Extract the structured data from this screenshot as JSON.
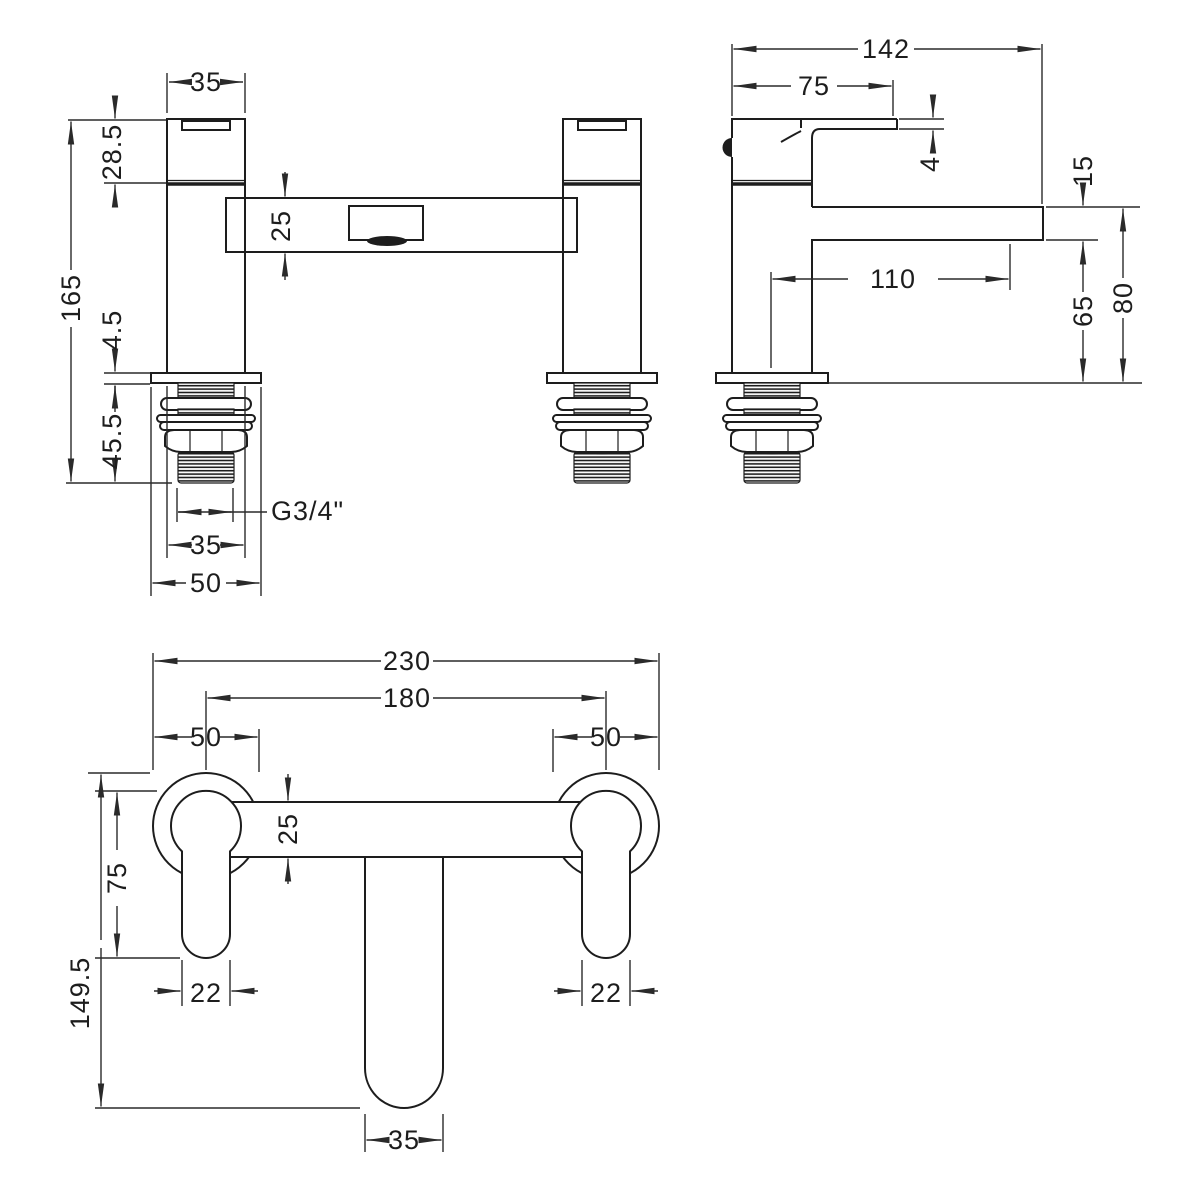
{
  "drawing": {
    "front": {
      "top_width": "35",
      "handle_height": "28.5",
      "overall_height": "165",
      "body_depth": "25",
      "deck_gap": "4.5",
      "tail_length": "45.5",
      "thread_spec": "G3/4\"",
      "thread_width": "35",
      "base_width": "50"
    },
    "side": {
      "overall_depth": "142",
      "handle_reach": "75",
      "handle_thickness": "4",
      "spout_thickness": "15",
      "spout_reach": "110",
      "spout_clearance": "65",
      "spout_height": "80"
    },
    "plan": {
      "overall_width": "230",
      "hole_centres": "180",
      "base_left": "50",
      "base_right": "50",
      "body_width": "25",
      "handle_length": "75",
      "overall_projection": "149.5",
      "handle_width_left": "22",
      "handle_width_right": "22",
      "spout_width": "35"
    }
  }
}
